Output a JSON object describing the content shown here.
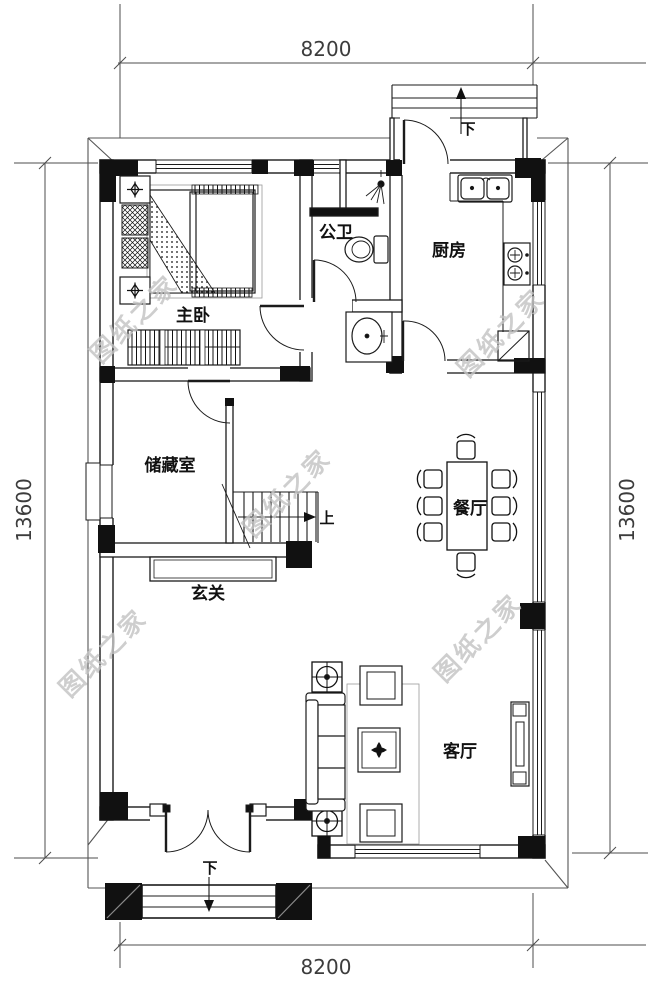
{
  "plan": {
    "dimensions": {
      "top": "8200",
      "bottom": "8200",
      "left": "13600",
      "right": "13600"
    },
    "rooms": {
      "master_bedroom": {
        "label": "主卧"
      },
      "bathroom": {
        "label": "公卫"
      },
      "kitchen": {
        "label": "厨房"
      },
      "storage": {
        "label": "储藏室"
      },
      "dining": {
        "label": "餐厅"
      },
      "foyer": {
        "label": "玄关"
      },
      "living": {
        "label": "客厅"
      }
    },
    "stairs": {
      "up_label": "上",
      "down_label_rear": "下",
      "down_label_entry": "下"
    },
    "watermark": {
      "text": "图纸之家",
      "color": "#c3c3c3"
    },
    "colors": {
      "line": "#1b1b1b",
      "dimension": "#3c3c3c",
      "background": "#ffffff"
    }
  }
}
